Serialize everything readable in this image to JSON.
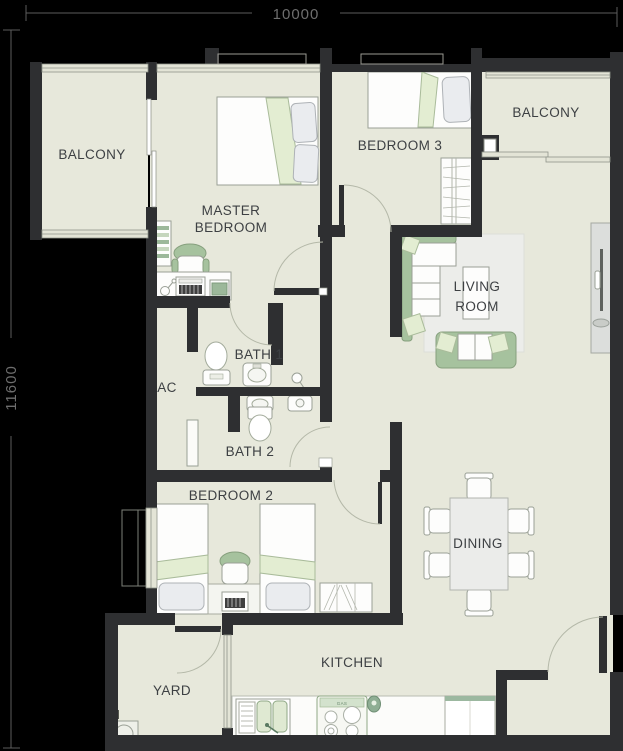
{
  "plan": {
    "type": "apartment-floor-plan",
    "dimensions": {
      "top": "10000",
      "left": "11600"
    },
    "rooms": {
      "balcony_left": {
        "label": "BALCONY"
      },
      "master_bedroom": {
        "line1": "MASTER",
        "line2": "BEDROOM"
      },
      "bedroom_3": {
        "label": "BEDROOM 3"
      },
      "balcony_right": {
        "label": "BALCONY"
      },
      "living_room": {
        "line1": "LIVING",
        "line2": "ROOM"
      },
      "bath_1": {
        "label": "BATH 1"
      },
      "ac": {
        "label": "AC"
      },
      "bath_2": {
        "label": "BATH 2"
      },
      "bedroom_2": {
        "label": "BEDROOM 2"
      },
      "dining": {
        "label": "DINING"
      },
      "yard": {
        "label": "YARD"
      },
      "kitchen": {
        "label": "KITCHEN"
      }
    },
    "kitchen_fixtures": {
      "stove_label": "GAS"
    },
    "colors": {
      "background": "#000000",
      "wall": "#2e2f31",
      "floor": "#e7e8db",
      "accent_green": "#a6c29e",
      "light_green": "#e3edd2",
      "furniture_white": "#fdfdfc",
      "label_text": "#3d4043",
      "dimension_text": "#6e6e6e"
    }
  }
}
